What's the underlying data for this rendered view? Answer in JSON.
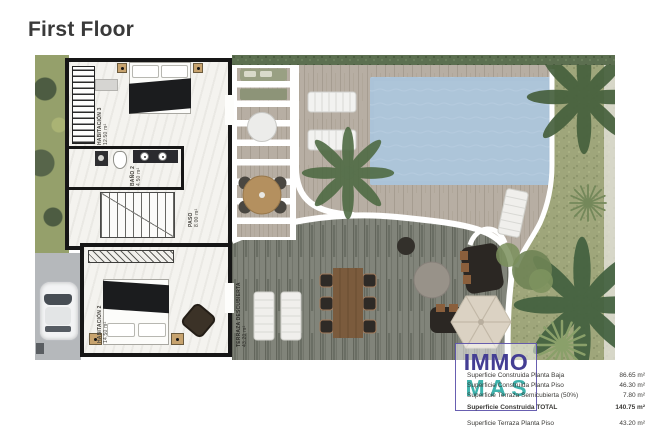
{
  "title": "First Floor",
  "plan": {
    "rooms": {
      "hab3": {
        "name": "HABITACIÓN 3",
        "area": "12.50 m²"
      },
      "bano2": {
        "name": "BAÑO 2",
        "area": "4.50 m²"
      },
      "paso": {
        "name": "PASO",
        "area": "8.00 m²"
      },
      "hab2": {
        "name": "HABITACIÓN 2",
        "area": "14.50 m²"
      },
      "terraza": {
        "name": "TERRAZA DESCUBIERTA",
        "area": "43.20 m²"
      }
    }
  },
  "logo": {
    "top": "IMMO",
    "bottom": "MAS",
    "top_color": "#443e94",
    "bottom_color": "#3eb2ac",
    "border_color": "#584ea8"
  },
  "summary": {
    "rows": [
      {
        "label": "Superficie Construida Planta Baja",
        "value": "86.65 m²"
      },
      {
        "label": "Superficie Construida Planta Piso",
        "value": "46.30 m²"
      },
      {
        "label": "Superficie Terraza Semicubierta (50%)",
        "value": "7.80 m²"
      },
      {
        "label": "Superficie Construida TOTAL",
        "value": "140.75 m²"
      },
      {
        "label": "Superficie Terraza Planta Piso",
        "value": "43.20 m²"
      }
    ]
  }
}
